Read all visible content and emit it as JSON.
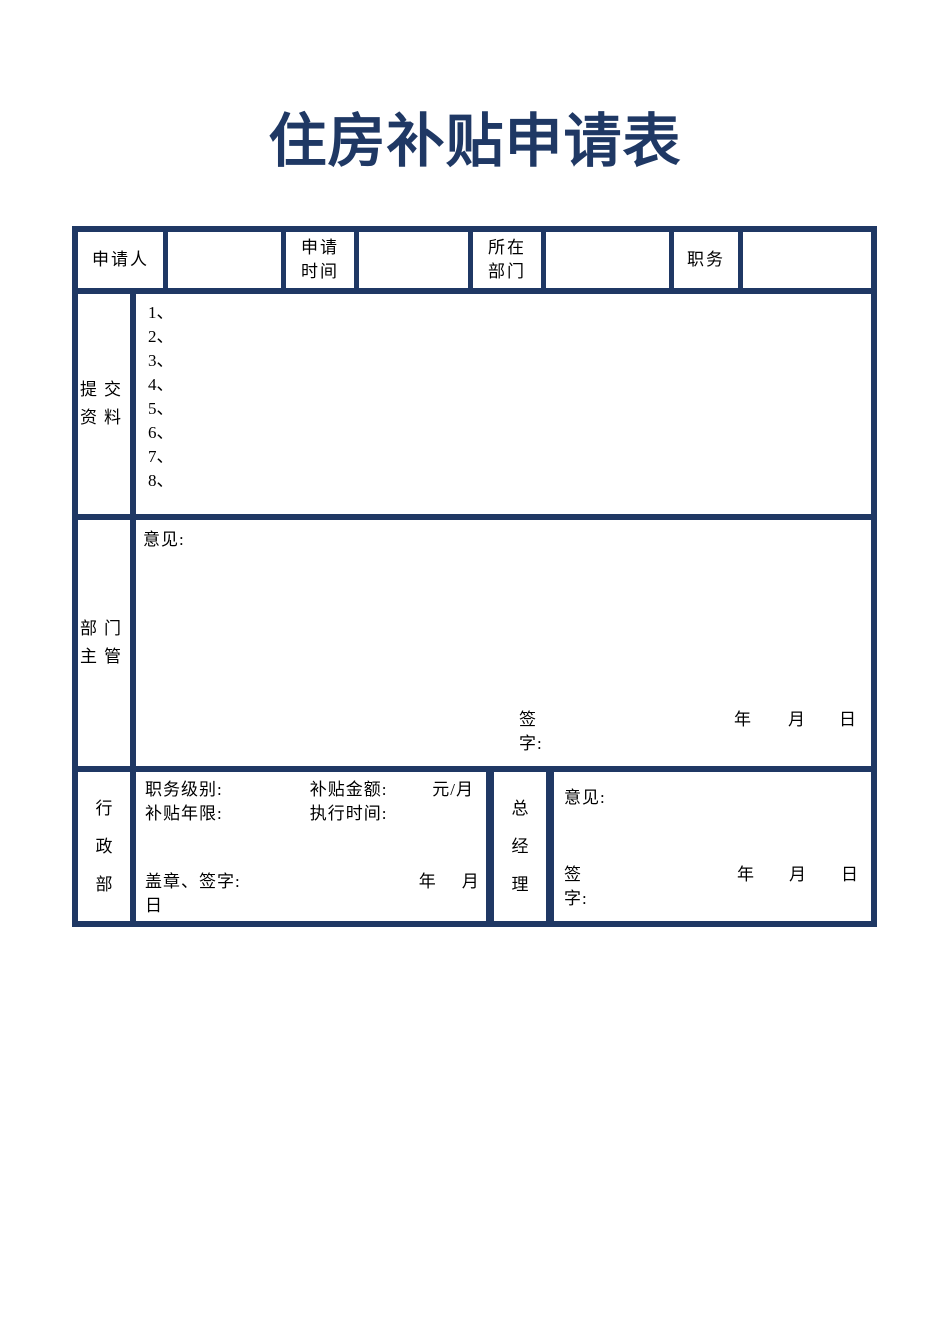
{
  "title": "住房补贴申请表",
  "colors": {
    "accent": "#1f3864",
    "text": "#000000"
  },
  "row1": {
    "applicant_label_lines": [
      "申请人"
    ],
    "apply_time_label_lines": [
      "申请",
      "时间"
    ],
    "department_label_lines": [
      "所在",
      "部门"
    ],
    "position_label_lines": [
      "职务"
    ]
  },
  "materials": {
    "label_lines": [
      "提交",
      "资料"
    ],
    "items": [
      "1、",
      "2、",
      "3、",
      "4、",
      "5、",
      "6、",
      "7、",
      "8、"
    ]
  },
  "dept_manager": {
    "label_lines": [
      "部门",
      "主管"
    ],
    "opinion_label": "意见:",
    "sign_label": "签字:",
    "year_label": "年",
    "month_label": "月",
    "day_label": "日"
  },
  "admin_dept": {
    "label_chars": [
      "行",
      "政",
      "部"
    ],
    "position_level_label": "职务级别:",
    "subsidy_amount_label": "补贴金额:",
    "amount_unit": "元/月",
    "subsidy_years_label": "补贴年限:",
    "execution_time_label": "执行时间:",
    "stamp_sign_label": "盖章、签字:",
    "year_label": "年",
    "month_label": "月",
    "day_label": "日"
  },
  "general_manager": {
    "label_chars": [
      "总",
      "经",
      "理"
    ],
    "opinion_label": "意见:",
    "sign_label": "签字:",
    "year_label": "年",
    "month_label": "月",
    "day_label": "日"
  }
}
